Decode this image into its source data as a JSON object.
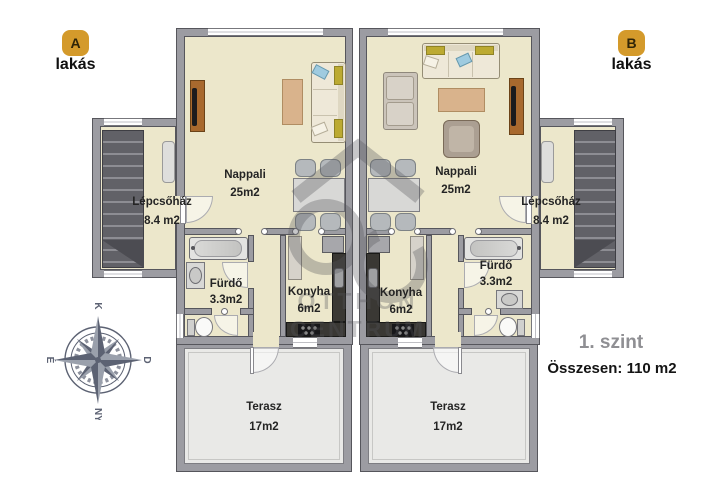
{
  "units": {
    "a": {
      "badge": "A",
      "label": "lakás",
      "rooms": {
        "nappali": {
          "name": "Nappali",
          "area": "25m2"
        },
        "lepcsohaz": {
          "name": "Lépcsőház",
          "area": "8.4 m2"
        },
        "furdo": {
          "name": "Fürdő",
          "area": "3.3m2"
        },
        "konyha": {
          "name": "Konyha",
          "area": "6m2"
        },
        "terasz": {
          "name": "Terasz",
          "area": "17m2"
        }
      }
    },
    "b": {
      "badge": "B",
      "label": "lakás",
      "rooms": {
        "nappali": {
          "name": "Nappali",
          "area": "25m2"
        },
        "lepcsohaz": {
          "name": "Lépcsőház",
          "area": "8.4 m2"
        },
        "furdo": {
          "name": "Fürdő",
          "area": "3.3m2"
        },
        "konyha": {
          "name": "Konyha",
          "area": "6m2"
        },
        "terasz": {
          "name": "Terasz",
          "area": "17m2"
        }
      }
    }
  },
  "floor_info": {
    "level": "1. szint",
    "total": "Összesen: 110 m2"
  },
  "compass": {
    "top": "K",
    "right": "D",
    "bottom": "NY",
    "left": "É"
  },
  "watermark": {
    "line1": "OTTHON",
    "line2": "CENTRUM"
  },
  "colors": {
    "badge_gold": "#d49a2b",
    "floor_beige": "#ece7cb",
    "wall_gray": "#9c9ca2",
    "terrace_gray": "#e9e9e7",
    "compass_slate": "#5c6273"
  }
}
